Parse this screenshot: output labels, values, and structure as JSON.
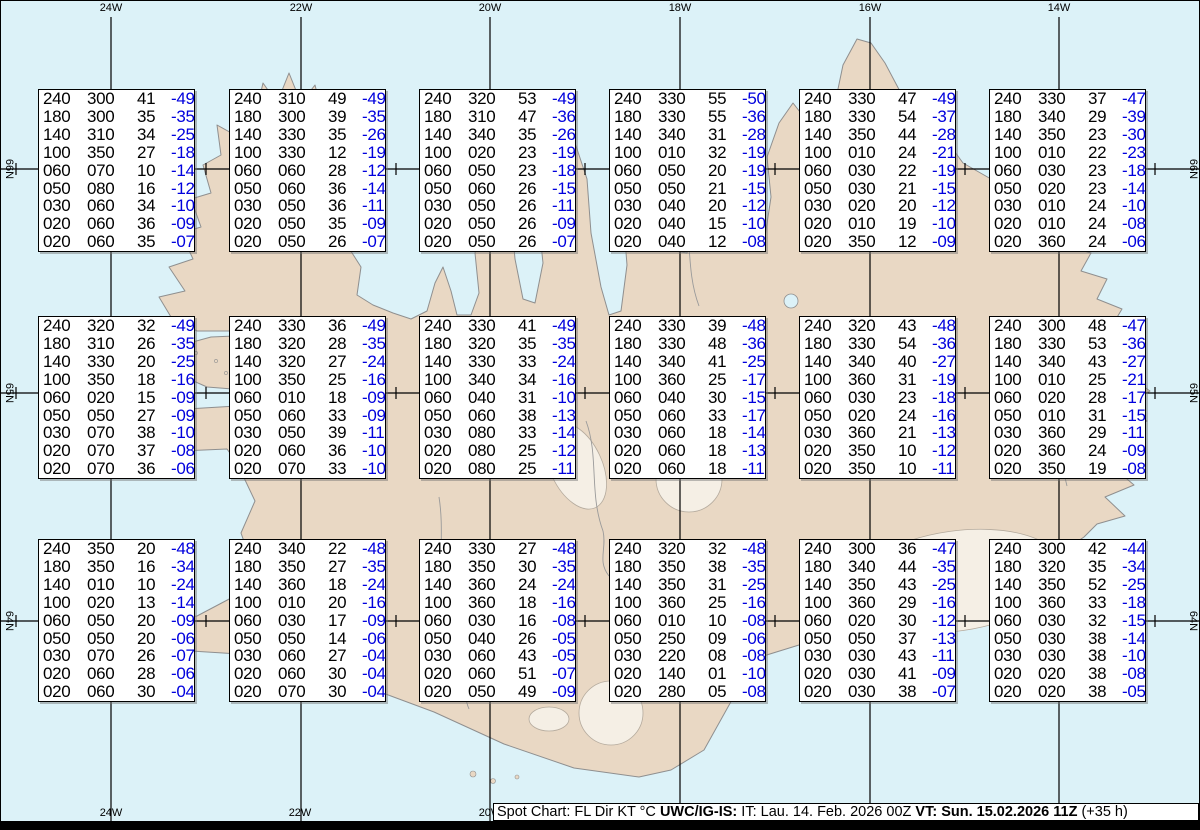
{
  "map": {
    "top_longitude_labels": [
      {
        "text": "24W",
        "x": 110
      },
      {
        "text": "22W",
        "x": 300
      },
      {
        "text": "20W",
        "x": 489
      },
      {
        "text": "18W",
        "x": 679
      },
      {
        "text": "16W",
        "x": 869
      },
      {
        "text": "14W",
        "x": 1058
      }
    ],
    "bottom_longitude_labels": [
      {
        "text": "24W",
        "x": 110
      },
      {
        "text": "22W",
        "x": 299
      },
      {
        "text": "20W",
        "x": 489
      }
    ],
    "left_latitude_labels": [
      {
        "text": "66N",
        "y": 168
      },
      {
        "text": "65N",
        "y": 392
      },
      {
        "text": "64N",
        "y": 620
      }
    ],
    "right_latitude_labels": [
      {
        "text": "66N",
        "y": 168
      },
      {
        "text": "65N",
        "y": 392
      },
      {
        "text": "64N",
        "y": 620
      }
    ],
    "colors": {
      "water": "#dcf2f8",
      "land": "#e9d8c4",
      "coast": "#8f8f8f",
      "glacier": "#f5efe5",
      "graticule": "#000000",
      "temperature_text": "#0000dd"
    }
  },
  "footer": {
    "prefix": "Spot Chart: FL Dir KT °C ",
    "product": "UWC/IG-IS:",
    "issue": " IT: Lau. 14. Feb. 2026 00Z ",
    "valid": "VT: Sun. 15.02.2026 11Z",
    "lead": " (+35 h)"
  },
  "chart_data": {
    "type": "table",
    "title": "Spot Chart: FL Dir KT °C (UWC/IG-IS)",
    "description": "Aviation spot chart over Iceland. Each grid box lists, per row: Flight Level (FL, hundreds of ft), wind direction (deg), wind speed (KT), temperature (°C, blue). Boxes ordered left-to-right, top-to-bottom on a 6x3 grid.",
    "columns": [
      "FL",
      "Dir",
      "KT",
      "°C"
    ],
    "grid": {
      "rows": 3,
      "cols": 6
    },
    "boxes": [
      [
        [
          "240",
          "300",
          "41",
          "-49"
        ],
        [
          "180",
          "300",
          "35",
          "-35"
        ],
        [
          "140",
          "310",
          "34",
          "-25"
        ],
        [
          "100",
          "350",
          "27",
          "-18"
        ],
        [
          "060",
          "070",
          "10",
          "-14"
        ],
        [
          "050",
          "080",
          "16",
          "-12"
        ],
        [
          "030",
          "060",
          "34",
          "-10"
        ],
        [
          "020",
          "060",
          "36",
          "-09"
        ],
        [
          "020",
          "060",
          "35",
          "-07"
        ]
      ],
      [
        [
          "240",
          "310",
          "49",
          "-49"
        ],
        [
          "180",
          "300",
          "39",
          "-35"
        ],
        [
          "140",
          "330",
          "35",
          "-26"
        ],
        [
          "100",
          "330",
          "12",
          "-19"
        ],
        [
          "060",
          "060",
          "28",
          "-12"
        ],
        [
          "050",
          "060",
          "36",
          "-14"
        ],
        [
          "030",
          "050",
          "36",
          "-11"
        ],
        [
          "020",
          "050",
          "35",
          "-09"
        ],
        [
          "020",
          "050",
          "26",
          "-07"
        ]
      ],
      [
        [
          "240",
          "320",
          "53",
          "-49"
        ],
        [
          "180",
          "310",
          "47",
          "-36"
        ],
        [
          "140",
          "340",
          "35",
          "-26"
        ],
        [
          "100",
          "020",
          "23",
          "-19"
        ],
        [
          "060",
          "050",
          "23",
          "-18"
        ],
        [
          "050",
          "060",
          "26",
          "-15"
        ],
        [
          "030",
          "050",
          "26",
          "-11"
        ],
        [
          "020",
          "050",
          "26",
          "-09"
        ],
        [
          "020",
          "050",
          "26",
          "-07"
        ]
      ],
      [
        [
          "240",
          "330",
          "55",
          "-50"
        ],
        [
          "180",
          "330",
          "55",
          "-36"
        ],
        [
          "140",
          "340",
          "31",
          "-28"
        ],
        [
          "100",
          "010",
          "32",
          "-19"
        ],
        [
          "060",
          "050",
          "20",
          "-19"
        ],
        [
          "050",
          "050",
          "21",
          "-15"
        ],
        [
          "030",
          "040",
          "20",
          "-12"
        ],
        [
          "020",
          "040",
          "15",
          "-10"
        ],
        [
          "020",
          "040",
          "12",
          "-08"
        ]
      ],
      [
        [
          "240",
          "330",
          "47",
          "-49"
        ],
        [
          "180",
          "330",
          "54",
          "-37"
        ],
        [
          "140",
          "350",
          "44",
          "-28"
        ],
        [
          "100",
          "010",
          "24",
          "-21"
        ],
        [
          "060",
          "030",
          "22",
          "-19"
        ],
        [
          "050",
          "030",
          "21",
          "-15"
        ],
        [
          "030",
          "020",
          "20",
          "-12"
        ],
        [
          "020",
          "010",
          "19",
          "-10"
        ],
        [
          "020",
          "350",
          "12",
          "-09"
        ]
      ],
      [
        [
          "240",
          "330",
          "37",
          "-47"
        ],
        [
          "180",
          "340",
          "29",
          "-39"
        ],
        [
          "140",
          "350",
          "23",
          "-30"
        ],
        [
          "100",
          "010",
          "22",
          "-23"
        ],
        [
          "060",
          "030",
          "23",
          "-18"
        ],
        [
          "050",
          "020",
          "23",
          "-14"
        ],
        [
          "030",
          "010",
          "24",
          "-10"
        ],
        [
          "020",
          "010",
          "24",
          "-08"
        ],
        [
          "020",
          "360",
          "24",
          "-06"
        ]
      ],
      [
        [
          "240",
          "320",
          "32",
          "-49"
        ],
        [
          "180",
          "310",
          "26",
          "-35"
        ],
        [
          "140",
          "330",
          "20",
          "-25"
        ],
        [
          "100",
          "350",
          "18",
          "-16"
        ],
        [
          "060",
          "020",
          "15",
          "-09"
        ],
        [
          "050",
          "050",
          "27",
          "-09"
        ],
        [
          "030",
          "070",
          "38",
          "-10"
        ],
        [
          "020",
          "070",
          "37",
          "-08"
        ],
        [
          "020",
          "070",
          "36",
          "-06"
        ]
      ],
      [
        [
          "240",
          "330",
          "36",
          "-49"
        ],
        [
          "180",
          "320",
          "28",
          "-35"
        ],
        [
          "140",
          "320",
          "27",
          "-24"
        ],
        [
          "100",
          "350",
          "25",
          "-16"
        ],
        [
          "060",
          "010",
          "18",
          "-09"
        ],
        [
          "050",
          "060",
          "33",
          "-09"
        ],
        [
          "030",
          "050",
          "39",
          "-11"
        ],
        [
          "020",
          "060",
          "36",
          "-10"
        ],
        [
          "020",
          "070",
          "33",
          "-10"
        ]
      ],
      [
        [
          "240",
          "330",
          "41",
          "-49"
        ],
        [
          "180",
          "320",
          "35",
          "-35"
        ],
        [
          "140",
          "330",
          "33",
          "-24"
        ],
        [
          "100",
          "340",
          "34",
          "-16"
        ],
        [
          "060",
          "040",
          "31",
          "-10"
        ],
        [
          "050",
          "060",
          "38",
          "-13"
        ],
        [
          "030",
          "080",
          "33",
          "-14"
        ],
        [
          "020",
          "080",
          "25",
          "-12"
        ],
        [
          "020",
          "080",
          "25",
          "-11"
        ]
      ],
      [
        [
          "240",
          "330",
          "39",
          "-48"
        ],
        [
          "180",
          "330",
          "48",
          "-36"
        ],
        [
          "140",
          "340",
          "41",
          "-25"
        ],
        [
          "100",
          "360",
          "25",
          "-17"
        ],
        [
          "060",
          "040",
          "30",
          "-15"
        ],
        [
          "050",
          "060",
          "33",
          "-17"
        ],
        [
          "030",
          "060",
          "18",
          "-14"
        ],
        [
          "020",
          "060",
          "18",
          "-13"
        ],
        [
          "020",
          "060",
          "18",
          "-11"
        ]
      ],
      [
        [
          "240",
          "320",
          "43",
          "-48"
        ],
        [
          "180",
          "330",
          "54",
          "-36"
        ],
        [
          "140",
          "340",
          "40",
          "-27"
        ],
        [
          "100",
          "360",
          "31",
          "-19"
        ],
        [
          "060",
          "030",
          "23",
          "-18"
        ],
        [
          "050",
          "020",
          "24",
          "-16"
        ],
        [
          "030",
          "360",
          "21",
          "-13"
        ],
        [
          "020",
          "350",
          "10",
          "-12"
        ],
        [
          "020",
          "350",
          "10",
          "-11"
        ]
      ],
      [
        [
          "240",
          "300",
          "48",
          "-47"
        ],
        [
          "180",
          "330",
          "53",
          "-36"
        ],
        [
          "140",
          "340",
          "43",
          "-27"
        ],
        [
          "100",
          "010",
          "25",
          "-21"
        ],
        [
          "060",
          "020",
          "28",
          "-17"
        ],
        [
          "050",
          "010",
          "31",
          "-15"
        ],
        [
          "030",
          "360",
          "29",
          "-11"
        ],
        [
          "020",
          "360",
          "24",
          "-09"
        ],
        [
          "020",
          "350",
          "19",
          "-08"
        ]
      ],
      [
        [
          "240",
          "350",
          "20",
          "-48"
        ],
        [
          "180",
          "350",
          "16",
          "-34"
        ],
        [
          "140",
          "010",
          "10",
          "-24"
        ],
        [
          "100",
          "020",
          "13",
          "-14"
        ],
        [
          "060",
          "050",
          "20",
          "-09"
        ],
        [
          "050",
          "050",
          "20",
          "-06"
        ],
        [
          "030",
          "070",
          "26",
          "-07"
        ],
        [
          "020",
          "060",
          "28",
          "-06"
        ],
        [
          "020",
          "060",
          "30",
          "-04"
        ]
      ],
      [
        [
          "240",
          "340",
          "22",
          "-48"
        ],
        [
          "180",
          "350",
          "27",
          "-35"
        ],
        [
          "140",
          "360",
          "18",
          "-24"
        ],
        [
          "100",
          "010",
          "20",
          "-16"
        ],
        [
          "060",
          "030",
          "17",
          "-09"
        ],
        [
          "050",
          "050",
          "14",
          "-06"
        ],
        [
          "030",
          "060",
          "27",
          "-04"
        ],
        [
          "020",
          "060",
          "30",
          "-04"
        ],
        [
          "020",
          "070",
          "30",
          "-04"
        ]
      ],
      [
        [
          "240",
          "330",
          "27",
          "-48"
        ],
        [
          "180",
          "350",
          "30",
          "-35"
        ],
        [
          "140",
          "360",
          "24",
          "-24"
        ],
        [
          "100",
          "360",
          "18",
          "-16"
        ],
        [
          "060",
          "030",
          "16",
          "-08"
        ],
        [
          "050",
          "040",
          "26",
          "-05"
        ],
        [
          "030",
          "060",
          "43",
          "-05"
        ],
        [
          "020",
          "060",
          "51",
          "-07"
        ],
        [
          "020",
          "050",
          "49",
          "-09"
        ]
      ],
      [
        [
          "240",
          "320",
          "32",
          "-48"
        ],
        [
          "180",
          "350",
          "38",
          "-35"
        ],
        [
          "140",
          "350",
          "31",
          "-25"
        ],
        [
          "100",
          "360",
          "25",
          "-16"
        ],
        [
          "060",
          "010",
          "10",
          "-08"
        ],
        [
          "050",
          "250",
          "09",
          "-06"
        ],
        [
          "030",
          "220",
          "08",
          "-08"
        ],
        [
          "020",
          "140",
          "01",
          "-10"
        ],
        [
          "020",
          "280",
          "05",
          "-08"
        ]
      ],
      [
        [
          "240",
          "300",
          "36",
          "-47"
        ],
        [
          "180",
          "340",
          "44",
          "-35"
        ],
        [
          "140",
          "350",
          "43",
          "-25"
        ],
        [
          "100",
          "360",
          "29",
          "-16"
        ],
        [
          "060",
          "020",
          "30",
          "-12"
        ],
        [
          "050",
          "050",
          "37",
          "-13"
        ],
        [
          "030",
          "030",
          "43",
          "-11"
        ],
        [
          "020",
          "030",
          "41",
          "-09"
        ],
        [
          "020",
          "030",
          "38",
          "-07"
        ]
      ],
      [
        [
          "240",
          "300",
          "42",
          "-44"
        ],
        [
          "180",
          "320",
          "35",
          "-34"
        ],
        [
          "140",
          "350",
          "52",
          "-25"
        ],
        [
          "100",
          "360",
          "33",
          "-18"
        ],
        [
          "060",
          "030",
          "32",
          "-15"
        ],
        [
          "050",
          "030",
          "38",
          "-14"
        ],
        [
          "030",
          "030",
          "38",
          "-10"
        ],
        [
          "020",
          "020",
          "38",
          "-08"
        ],
        [
          "020",
          "020",
          "38",
          "-05"
        ]
      ]
    ]
  }
}
